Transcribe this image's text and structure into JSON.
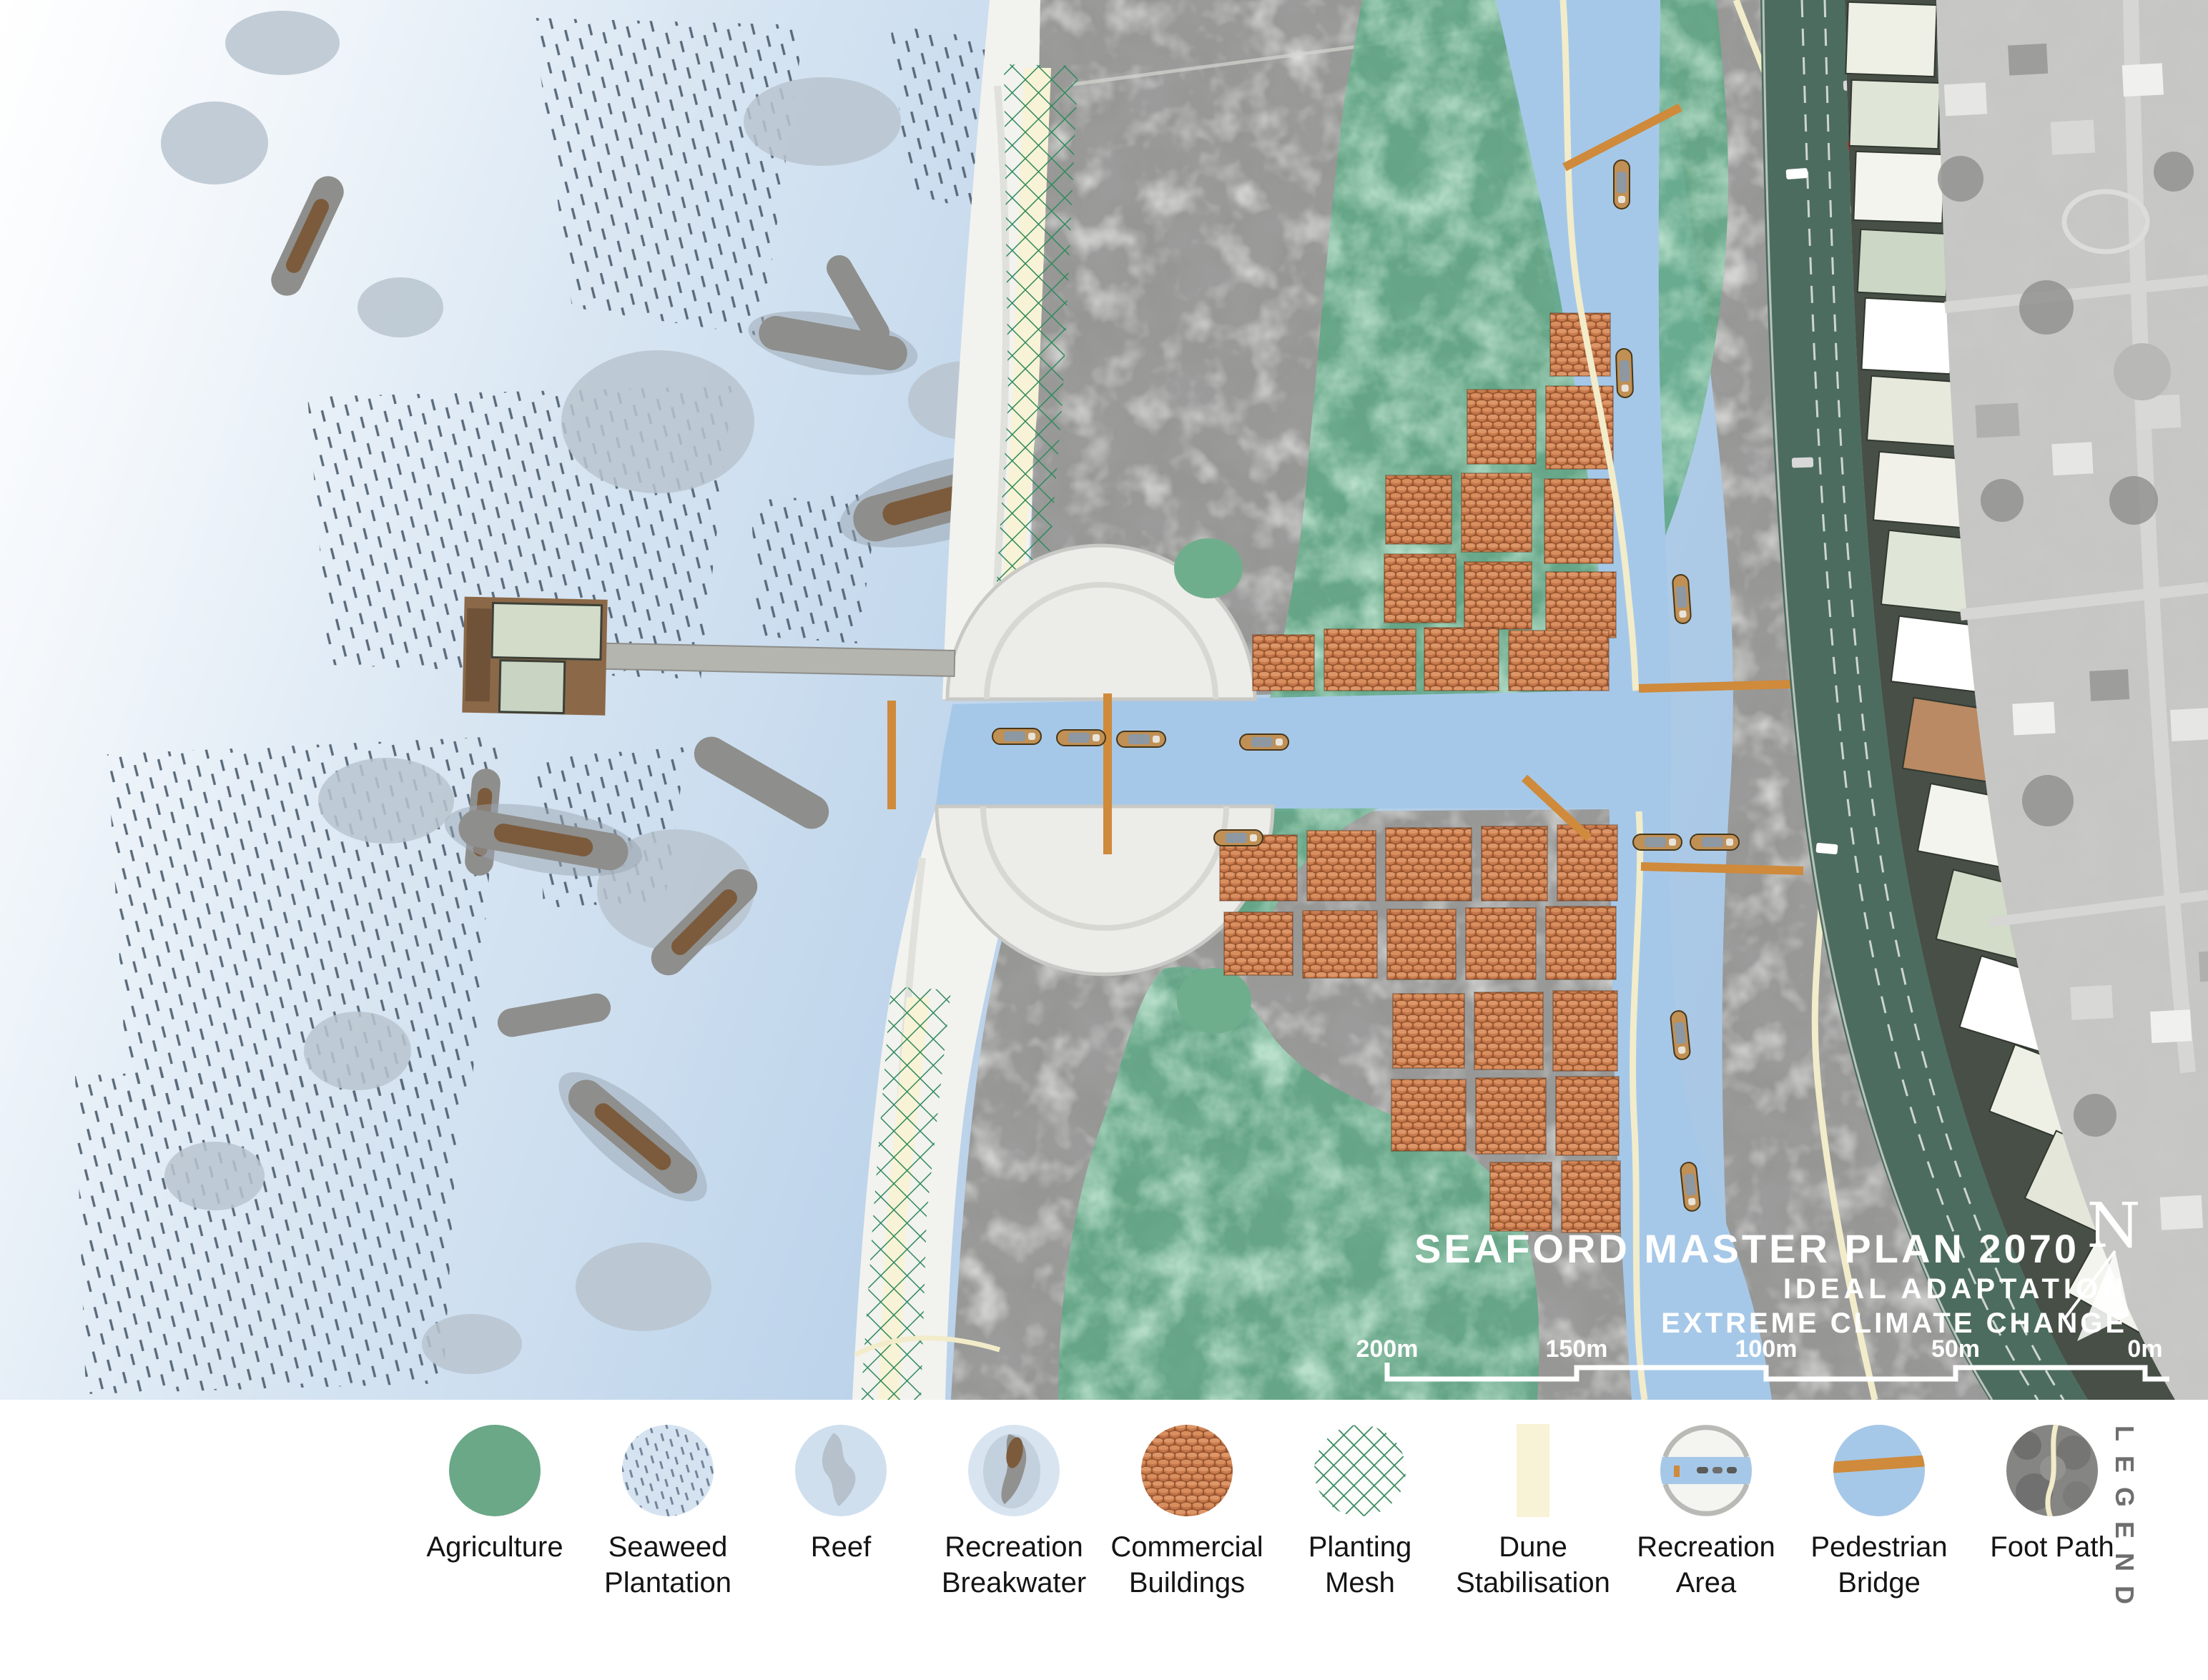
{
  "header": {
    "title": "SEAFORD MASTER PLAN 2070",
    "subtitle_line1": "IDEAL ADAPTATION",
    "subtitle_line2": "EXTREME CLIMATE CHANGE"
  },
  "compass": {
    "north_label": "N"
  },
  "scale_bar": {
    "labels": [
      "200m",
      "150m",
      "100m",
      "50m",
      "0m"
    ]
  },
  "legend": {
    "heading": "LEGEND",
    "items": [
      {
        "name": "agriculture",
        "label1": "Agriculture",
        "label2": ""
      },
      {
        "name": "seaweed-plantation",
        "label1": "Seaweed",
        "label2": "Plantation"
      },
      {
        "name": "reef",
        "label1": "Reef",
        "label2": ""
      },
      {
        "name": "recreation-breakwater",
        "label1": "Recreation",
        "label2": "Breakwater"
      },
      {
        "name": "commercial-buildings",
        "label1": "Commercial",
        "label2": "Buildings"
      },
      {
        "name": "planting-mesh",
        "label1": "Planting",
        "label2": "Mesh"
      },
      {
        "name": "dune-stabilisation",
        "label1": "Dune",
        "label2": "Stabilisation"
      },
      {
        "name": "recreation-area",
        "label1": "Recreation",
        "label2": "Area"
      },
      {
        "name": "pedestrian-bridge",
        "label1": "Pedestrian",
        "label2": "Bridge"
      },
      {
        "name": "foot-path",
        "label1": "Foot Path",
        "label2": ""
      }
    ]
  },
  "colors": {
    "ocean_blue": "#a6c6e5",
    "water_blue": "#a6c8e8",
    "agriculture_green": "#5ea684",
    "mesh_green": "#2f8a5c",
    "dune_cream": "#f8f3d6",
    "footpath_cream": "#f2ecca",
    "bridge_orange": "#cf8a3b",
    "roof_terracotta": "#c97a4b",
    "road_green": "#4c6c5f",
    "tree_gray": "#8f8f8d",
    "beach_white": "#f2f2ef"
  }
}
